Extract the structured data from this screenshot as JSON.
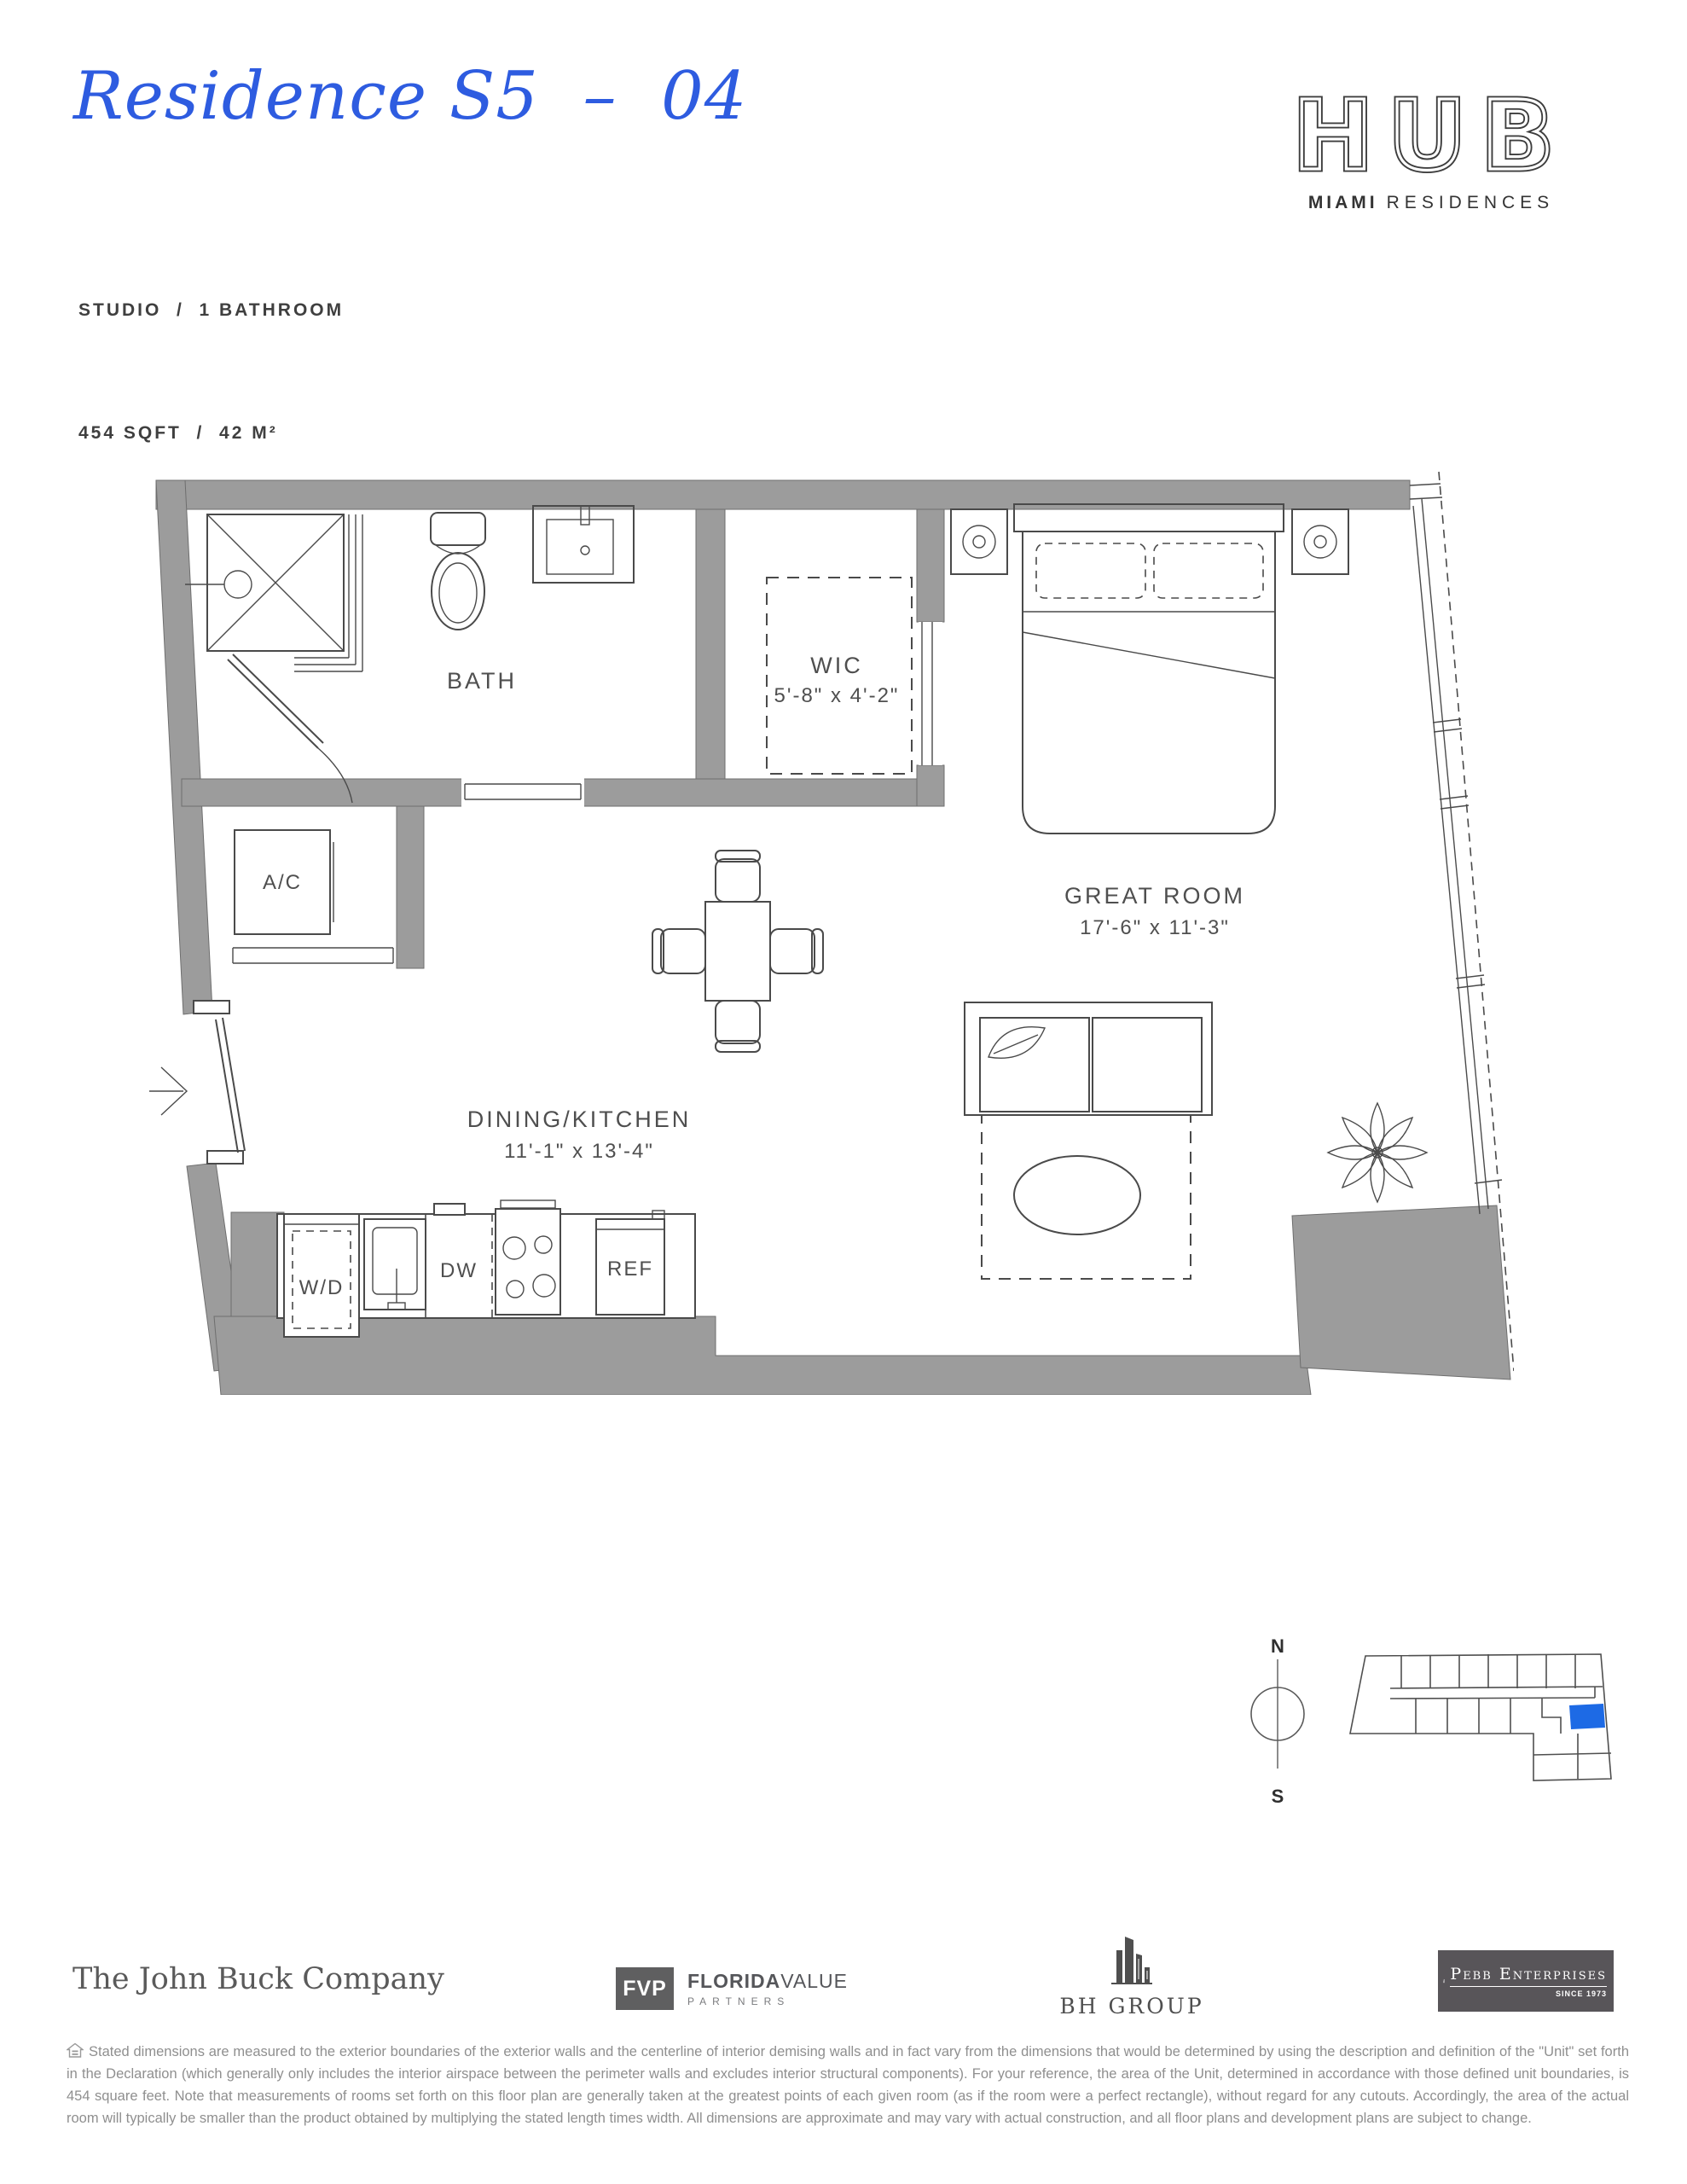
{
  "colors": {
    "accent_blue": "#2e5ce0",
    "wall_gray": "#9c9c9c",
    "line": "#4a4a4a",
    "keyplan_unit_blue": "#1d6ae5"
  },
  "header": {
    "title": "Residence S5  –  04",
    "spec_line1": "STUDIO  /  1 BATHROOM",
    "spec_line2": "454 SQFT  /  42 M²",
    "brand": {
      "name": "HUB",
      "tagline_bold": "MIAMI",
      "tagline_light": "RESIDENCES"
    }
  },
  "floorplan": {
    "rooms": [
      {
        "label": "BATH"
      },
      {
        "label": "WIC",
        "dims": "5'-8\" x 4'-2\""
      },
      {
        "label": "A/C"
      },
      {
        "label": "GREAT ROOM",
        "dims": "17'-6\" x 11'-3\""
      },
      {
        "label": "DINING/KITCHEN",
        "dims": "11'-1\" x 13'-4\""
      }
    ],
    "fixtures": [
      {
        "label": "W/D"
      },
      {
        "label": "DW"
      },
      {
        "label": "REF"
      }
    ]
  },
  "orientation": {
    "north": "N",
    "south": "S"
  },
  "footer": {
    "partners": [
      {
        "name": "The John Buck Company"
      },
      {
        "abbr": "FVP",
        "name_bold": "FLORIDA",
        "name_light": "VALUE",
        "subtitle": "PARTNERS"
      },
      {
        "name": "BH GROUP"
      },
      {
        "name": "Pebb Enterprises",
        "subtitle": "SINCE 1973"
      }
    ],
    "disclaimer": "Stated dimensions are measured to the exterior boundaries of the exterior walls and the centerline of interior demising walls and in fact vary from the dimensions that would be determined by using the description and definition of the \"Unit\" set forth in the Declaration (which generally only includes the interior airspace between the perimeter walls and excludes interior structural components).  For your reference, the area of the Unit, determined in accordance with those defined unit boundaries, is 454 square feet.  Note that measurements of rooms set forth on this floor plan are generally taken at the greatest points of each given room (as if the room were a perfect rectangle), without regard for any cutouts.  Accordingly, the area of the actual room will typically be smaller than the product obtained by multiplying the stated length times width.  All dimensions are approximate and may vary with actual construction, and all floor plans and development plans are subject to change."
  }
}
